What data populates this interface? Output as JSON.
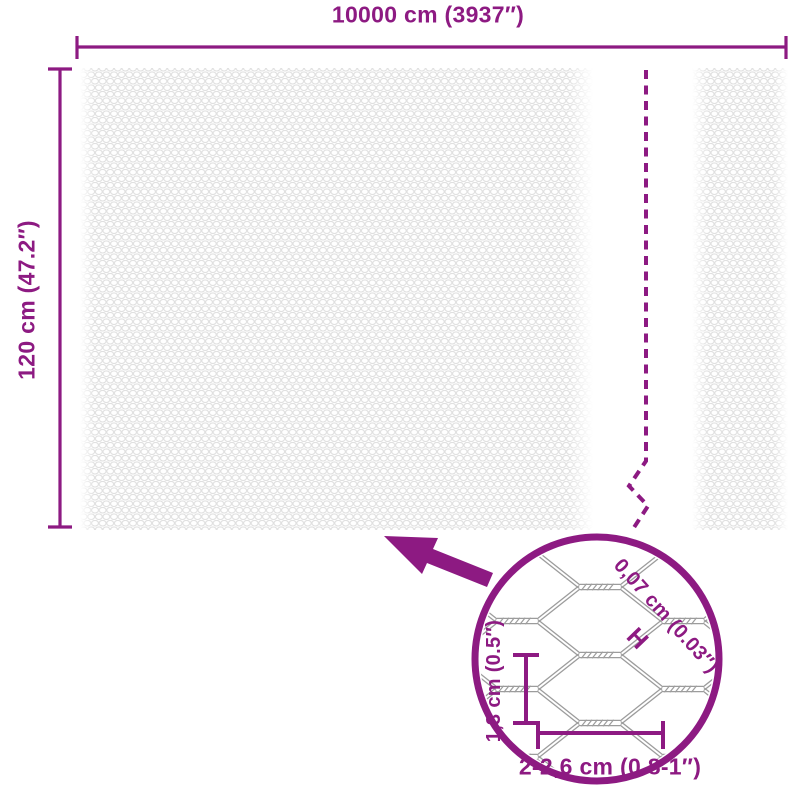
{
  "colors": {
    "accent": "#8d1a82",
    "mesh_pattern": "#e0e0e0",
    "wire": "#9c9c9c"
  },
  "dimensions": {
    "width_label": "10000 cm (3937″)",
    "height_label": "120 cm (47.2″)",
    "wire_thickness_label": "0,07 cm (0.03″)",
    "wire_gauge_marker": "H",
    "mesh_opening_height_label": "1,3 cm (0.5″)",
    "mesh_opening_width_label": "2-2,6 cm (0.8-1″)"
  }
}
